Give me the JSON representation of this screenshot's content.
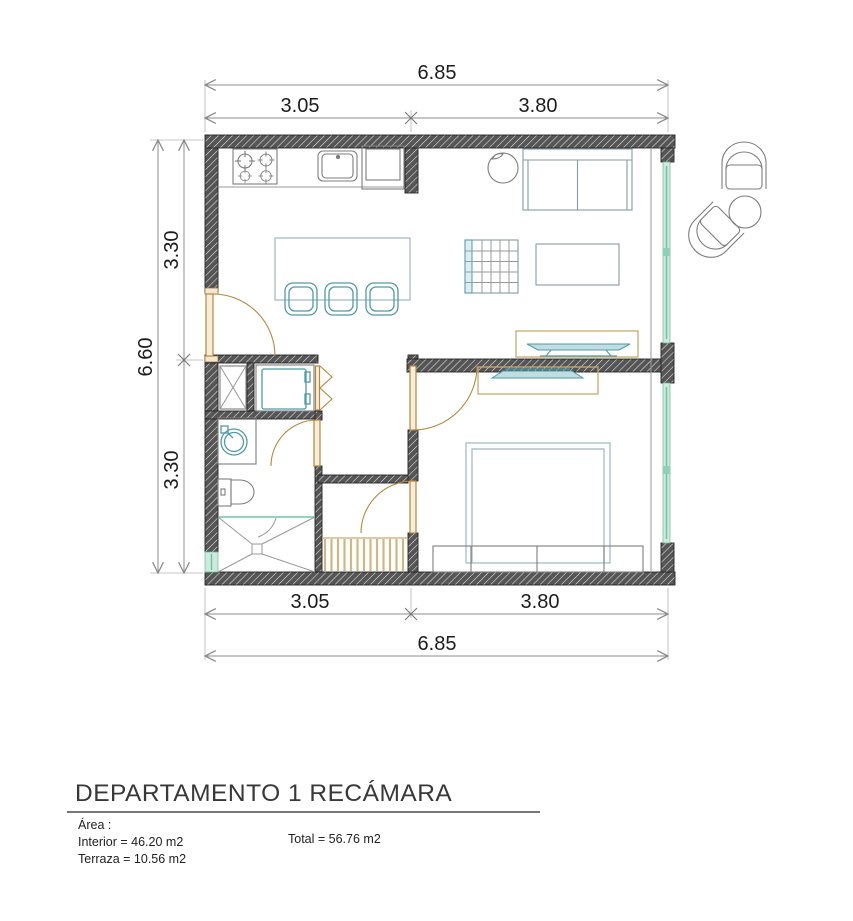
{
  "drawing": {
    "dimensions": {
      "top": {
        "total": "6.85",
        "left": "3.05",
        "right": "3.80"
      },
      "bottom": {
        "left": "3.05",
        "right": "3.80",
        "total": "6.85"
      },
      "left": {
        "total": "6.60",
        "upper": "3.30",
        "lower": "3.30"
      }
    },
    "title_block": {
      "title": "DEPARTAMENTO 1 RECÁMARA",
      "area_label": "Área :",
      "interior_area": "Interior = 46.20 m2",
      "terrace_area": "Terraza = 10.56 m2",
      "total_area": "Total = 56.76 m2"
    },
    "colors": {
      "wall": "#555555",
      "door": "#b5873e",
      "wood": "#c9a96e",
      "fixture": "#4f9aa8",
      "glass": "#cdeadd",
      "glass_line": "#6ec4a8",
      "furniture": "#879ba3",
      "dim_line": "#8c8c8c",
      "text": "#1c1c1c"
    }
  }
}
